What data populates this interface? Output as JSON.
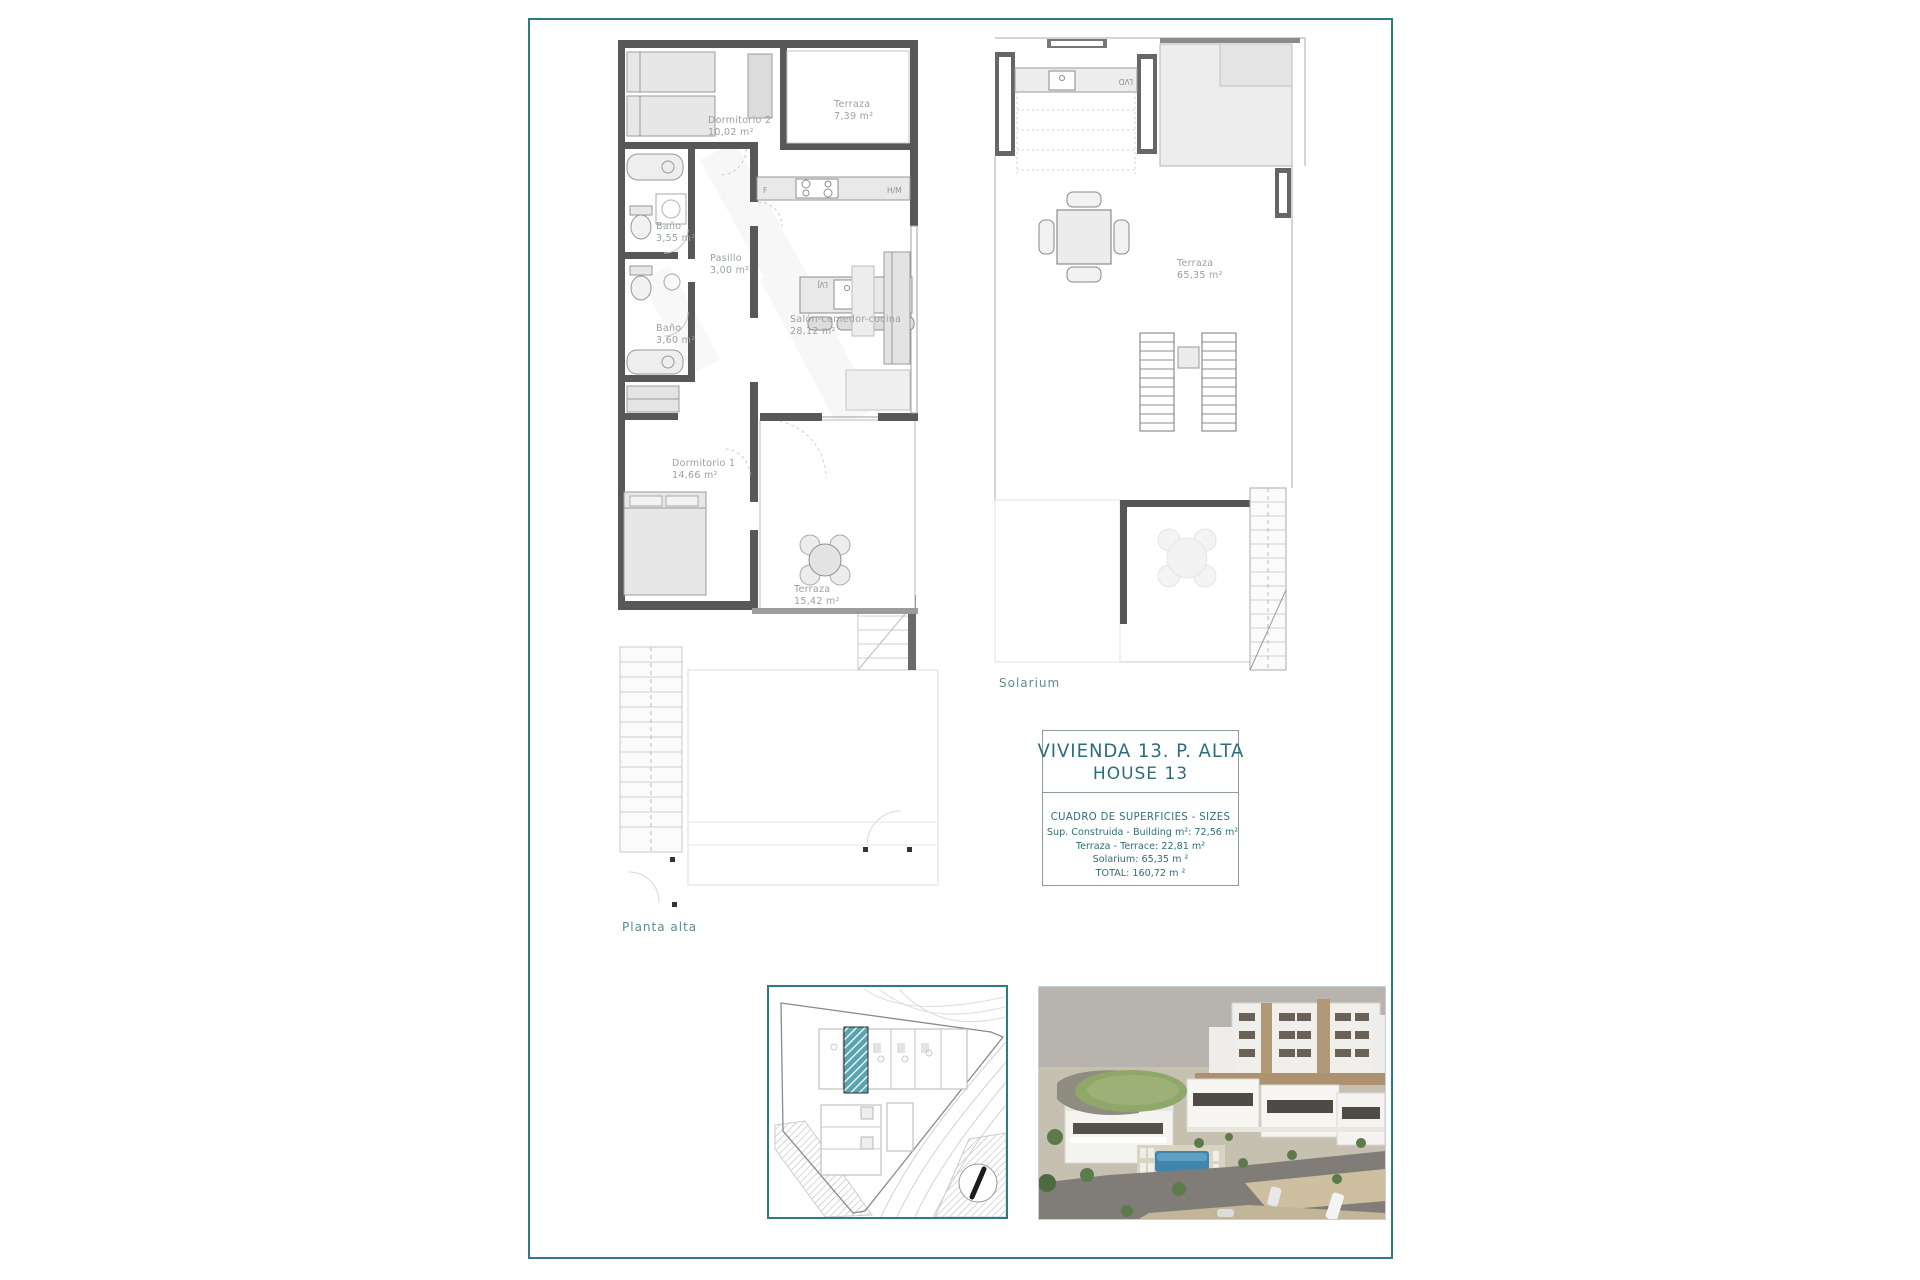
{
  "document": {
    "left_plan": {
      "floor_label": "Planta alta",
      "rooms": {
        "dormitorio2": {
          "name": "Dormitorio 2",
          "area": "10,02 m²"
        },
        "terraza_top": {
          "name": "Terraza",
          "area": "7,39 m²"
        },
        "bano1": {
          "name": "Baño",
          "area": "3,55 m²"
        },
        "pasillo": {
          "name": "Pasillo",
          "area": "3,00 m²"
        },
        "bano2": {
          "name": "Baño",
          "area": "3,60 m²"
        },
        "salon": {
          "name": "Salón-comedor-cocina",
          "area": "28,12 m²"
        },
        "dormitorio1": {
          "name": "Dormitorio 1",
          "area": "14,66 m²"
        },
        "terraza_bottom": {
          "name": "Terraza",
          "area": "15,42 m²"
        }
      },
      "appliance_labels": {
        "fridge": "F",
        "oven": "H/M",
        "dishwasher": "LVJ"
      }
    },
    "right_plan": {
      "floor_label": "Solarium",
      "rooms": {
        "terraza": {
          "name": "Terraza",
          "area": "65,35 m²"
        }
      },
      "appliance_labels": {
        "laundry": "LVD"
      }
    },
    "title_block": {
      "title_es": "VIVIENDA 13. P. ALTA",
      "title_en": "HOUSE 13",
      "table_title": "CUADRO DE SUPERFICIES  - SIZES",
      "rows": [
        {
          "text": "Sup. Construida  - Building m²: 72,56 m²"
        },
        {
          "text": "Terraza  -  Terrace: 22,81 m²"
        },
        {
          "text": "Solarium: 65,35 m ²"
        },
        {
          "text": "TOTAL:  160,72 m ²"
        }
      ]
    },
    "colors": {
      "accent_teal": "#2e7b85",
      "text_teal": "#2d6e7e",
      "label_gray": "#98a1a2",
      "wall_dark": "#585858",
      "pool_blue": "#3f86ae"
    }
  }
}
